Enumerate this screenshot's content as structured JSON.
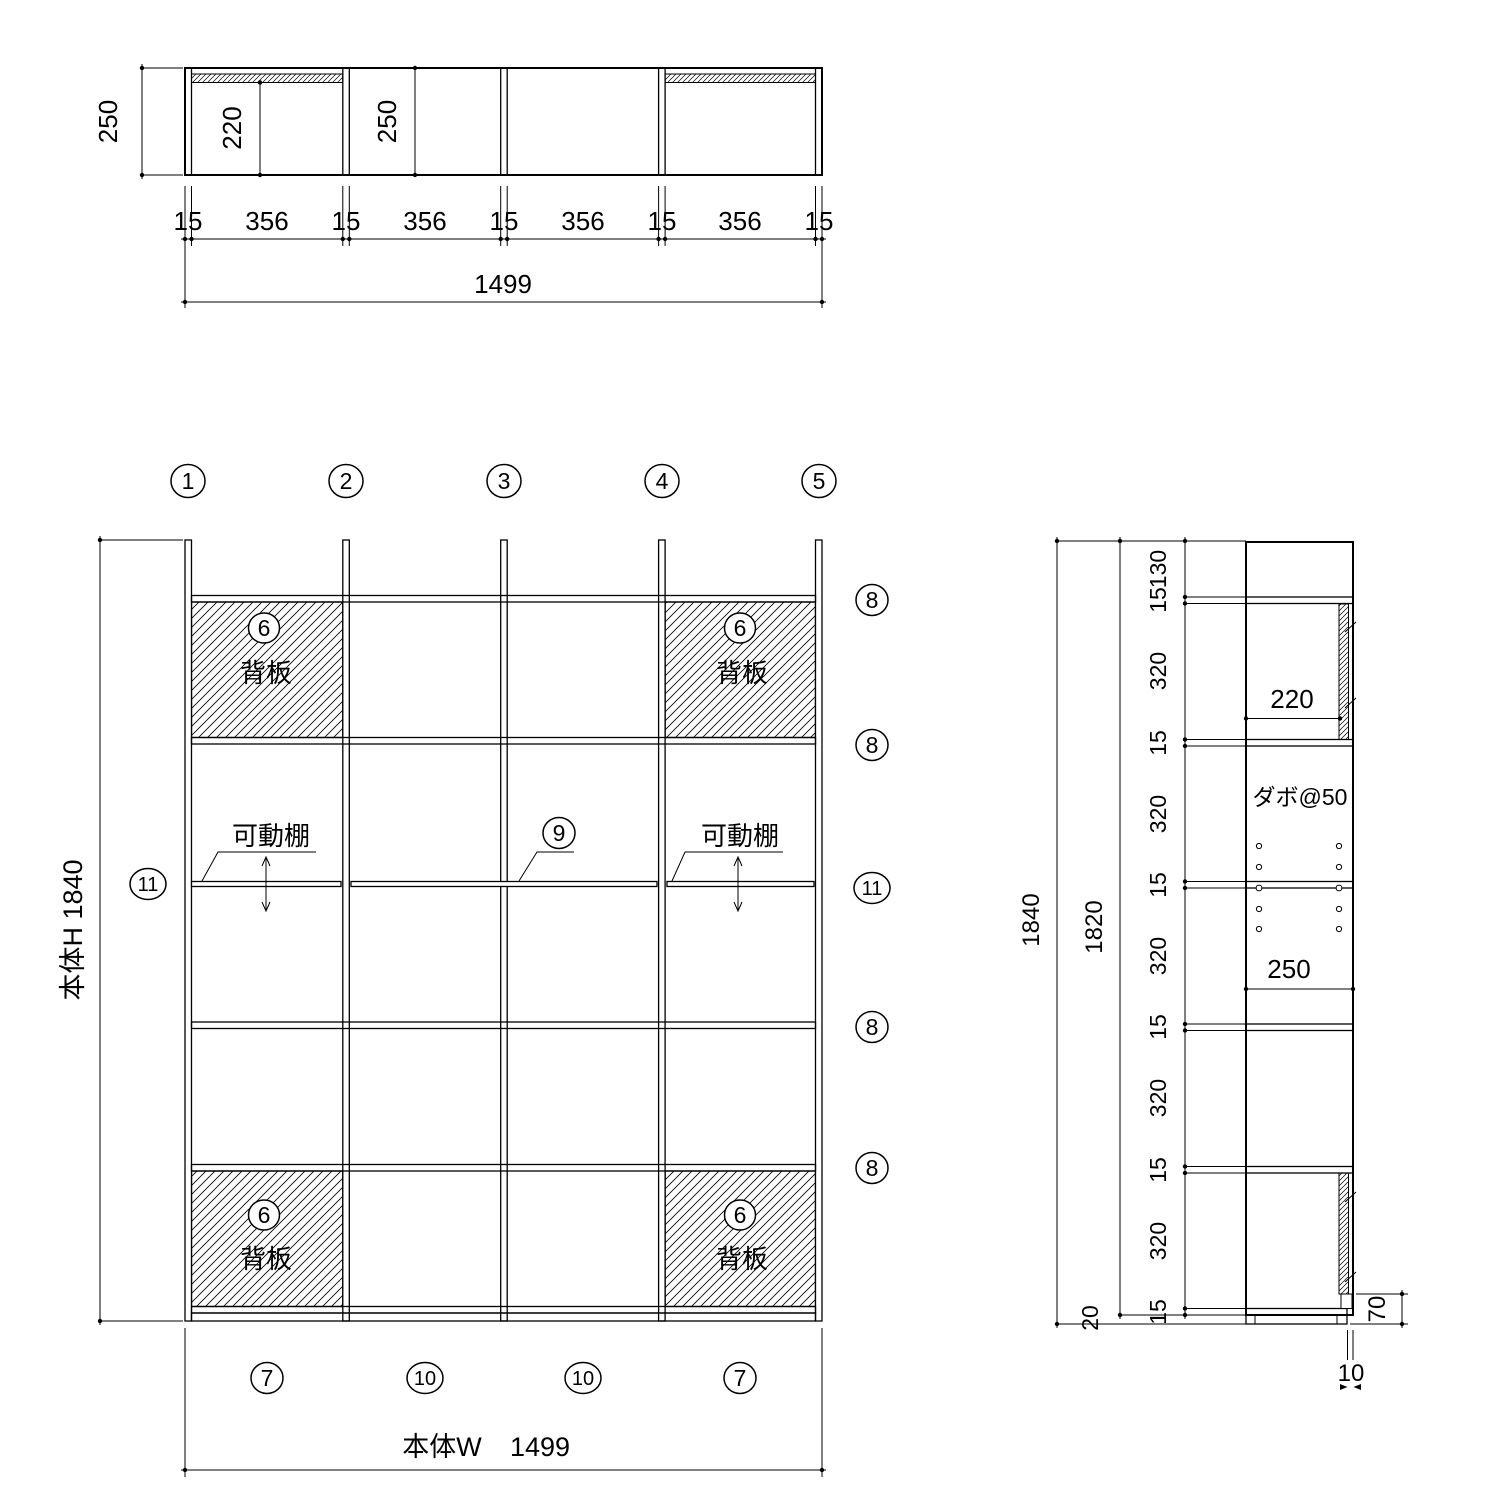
{
  "top": {
    "depth": "250",
    "clear": "220",
    "depth2": "250",
    "dims": [
      "15",
      "356",
      "15",
      "356",
      "15",
      "356",
      "15",
      "356",
      "15"
    ],
    "total": "1499"
  },
  "front": {
    "cols": [
      "1",
      "2",
      "3",
      "4",
      "5"
    ],
    "right": [
      "8",
      "8",
      "11",
      "8",
      "8"
    ],
    "left": "11",
    "panel_no": "6",
    "panel": "背板",
    "movable": "可動棚",
    "shelf_no": "9",
    "bottom": [
      "7",
      "10",
      "10",
      "7"
    ],
    "h_label": "本体H 1840",
    "w_label": "本体W",
    "w_value": "1499"
  },
  "side": {
    "total": "1840",
    "inner": "1820",
    "stack": [
      "130",
      "15",
      "320",
      "15",
      "320",
      "15",
      "320",
      "15",
      "320",
      "15",
      "320",
      "15"
    ],
    "base": "20",
    "depth": "250",
    "clear": "220",
    "dowel": "ダボ@50",
    "toe": "70",
    "gap": "10"
  }
}
